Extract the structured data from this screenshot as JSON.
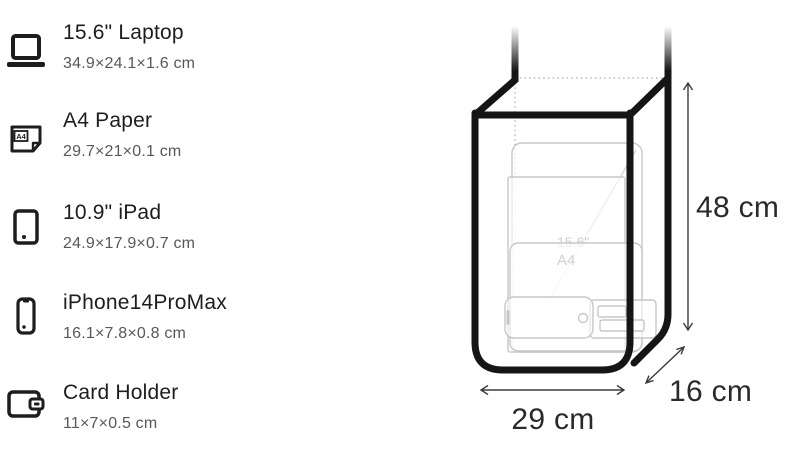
{
  "items": [
    {
      "name": "15.6\" Laptop",
      "dims": "34.9×24.1×1.6 cm",
      "icon": "laptop-icon"
    },
    {
      "name": "A4 Paper",
      "dims": "29.7×21×0.1 cm",
      "icon": "a4-paper-icon",
      "icon_label": "A4"
    },
    {
      "name": "10.9\" iPad",
      "dims": "24.9×17.9×0.7 cm",
      "icon": "tablet-icon"
    },
    {
      "name": "iPhone14ProMax",
      "dims": "16.1×7.8×0.8 cm",
      "icon": "phone-icon"
    },
    {
      "name": "Card Holder",
      "dims": "11×7×0.5 cm",
      "icon": "wallet-icon"
    }
  ],
  "diagram": {
    "height_label": "48 cm",
    "width_label": "29 cm",
    "depth_label": "16 cm",
    "ghost_laptop_label": "15.6\"",
    "ghost_a4_label": "A4",
    "colors": {
      "outline": "#151517",
      "ghost": "#c7c7cb",
      "dotted": "#b9b9bc",
      "arrow": "#3b3b3e",
      "text": "#1d1d1f",
      "subtext": "#58585c"
    }
  }
}
